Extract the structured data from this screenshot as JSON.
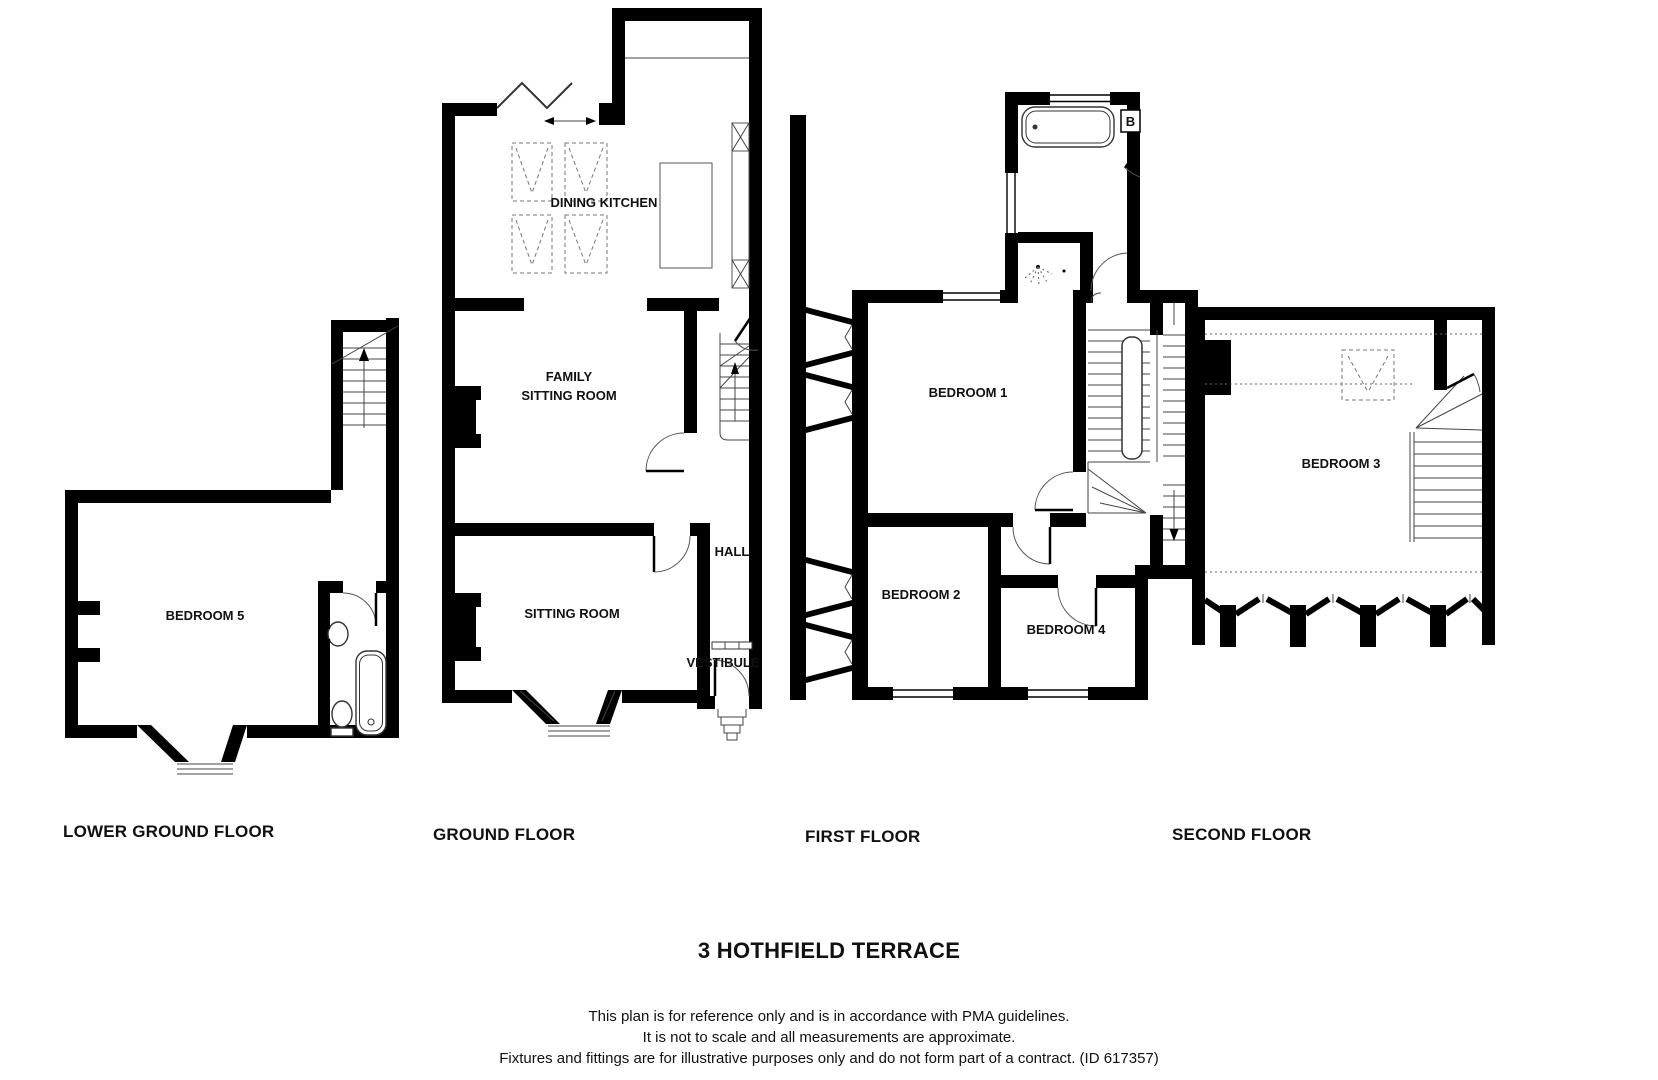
{
  "page": {
    "background": "#ffffff",
    "wall_color": "#000000",
    "line_color": "#444444"
  },
  "title": "3 HOTHFIELD TERRACE",
  "disclaimer": {
    "line1": "This plan is for reference only and is in accordance with PMA guidelines.",
    "line2": "It is not to scale and all measurements are approximate.",
    "line3": "Fixtures and fittings are for illustrative purposes only and do not form part of a contract. (ID 617357)"
  },
  "floors": {
    "lower_ground": {
      "label": "LOWER GROUND FLOOR",
      "rooms": {
        "bedroom5": "BEDROOM 5"
      }
    },
    "ground": {
      "label": "GROUND FLOOR",
      "rooms": {
        "dining_kitchen": "DINING KITCHEN",
        "family_line1": "FAMILY",
        "family_line2": "SITTING ROOM",
        "hall": "HALL",
        "sitting_room": "SITTING ROOM",
        "vestibule": "VESTIBULE"
      }
    },
    "first": {
      "label": "FIRST FLOOR",
      "rooms": {
        "bedroom1": "BEDROOM 1",
        "bedroom2": "BEDROOM 2",
        "bedroom4": "BEDROOM 4",
        "boiler": "B"
      }
    },
    "second": {
      "label": "SECOND FLOOR",
      "rooms": {
        "bedroom3": "BEDROOM 3"
      }
    }
  }
}
